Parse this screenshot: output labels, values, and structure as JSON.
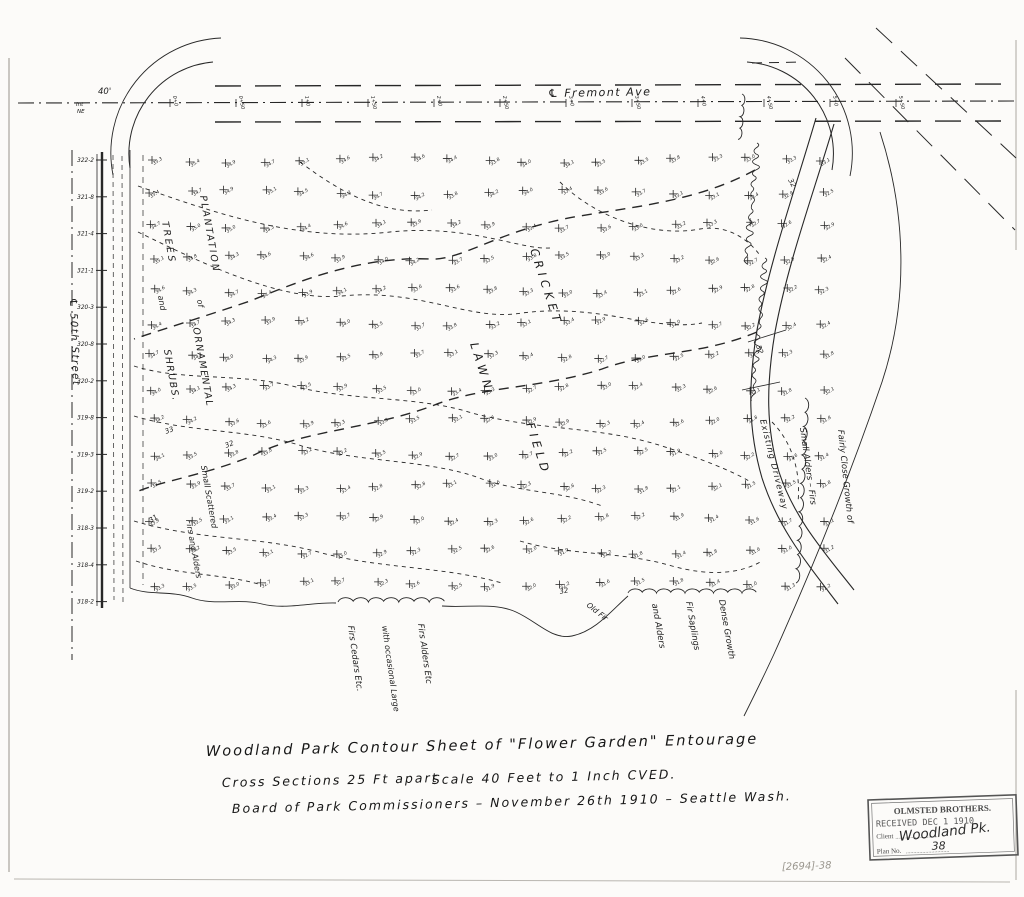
{
  "document": {
    "kind": "scanned survey contour map",
    "pencil_note": "[2694]-38"
  },
  "title_block": {
    "line1": "Woodland Park  Contour Sheet  of  \"Flower Garden\"  Entourage",
    "line2_left": "Cross Sections  25 Ft apart",
    "line2_right": "Scale 40  Feet  to  1 Inch   CVED.",
    "line3": "Board of Park Commissioners   – November 26th 1910 –   Seattle  Wash."
  },
  "stamp": {
    "org": "OLMSTED BROTHERS.",
    "received": "RECEIVED  DEC 1 1910",
    "client_label": "Client",
    "client_value": "Woodland Pk.",
    "plan_label": "Plan No.",
    "plan_value": "38",
    "dots": "............................."
  },
  "map": {
    "streets": {
      "fremont": "℄ Fremont  Ave",
      "fiftieth": "℄ 50th  Street",
      "width_label": "40'",
      "corner_note_top": "Int",
      "corner_note_bottom": "NE"
    },
    "stations": [
      "0+0",
      "0+50",
      "1+0",
      "1+50",
      "2+0",
      "2+50",
      "3+0",
      "3+50",
      "4+0",
      "4+50",
      "5+0",
      "5+50"
    ],
    "section_labels": [
      "322-2",
      "321-8",
      "321-4",
      "321-1",
      "320-3",
      "320-8",
      "320-2",
      "319-8",
      "319-3",
      "319-2",
      "318-3",
      "318-4",
      "318-2"
    ],
    "area_labels": {
      "plantation": "PLANTATION",
      "of": "of",
      "ornamental": "ORNAMENTAL",
      "trees": "TREES",
      "and": "and",
      "shrubs": "SHRUBS.",
      "cricket": "CRICKET",
      "lawn": "LAWN",
      "field": "FIELD",
      "small_scattered": "Small Scattered",
      "firs_and_alders": "Firs and Alders",
      "firs_cedars": "Firs Cedars Etc.",
      "with_occasional": "with occasional Large",
      "firs_alders": "Firs Alders Etc",
      "and_alders": "and Alders",
      "fir_saplings": "Fir Saplings",
      "dense_growth": "Dense Growth",
      "small_alders_firs": "Small Alders – Firs",
      "existing_driveway": "Existing Driveway",
      "fairly_close": "Fairly Close Growth of",
      "old_fir": "Old Fir"
    },
    "contour_labels": [
      "33",
      "32",
      "31",
      "32",
      "32",
      "32"
    ],
    "survey_grid": {
      "cols": 19,
      "rows": 14,
      "elev_base": 35.3,
      "col_step": -0.13,
      "row_step": -0.15,
      "wobble": 0.3,
      "elev_min": 30.5,
      "elev_max": 35.4
    },
    "colors": {
      "ink": "#272727",
      "paper": "#fcfbf9",
      "pencil": "#9a968e"
    }
  }
}
